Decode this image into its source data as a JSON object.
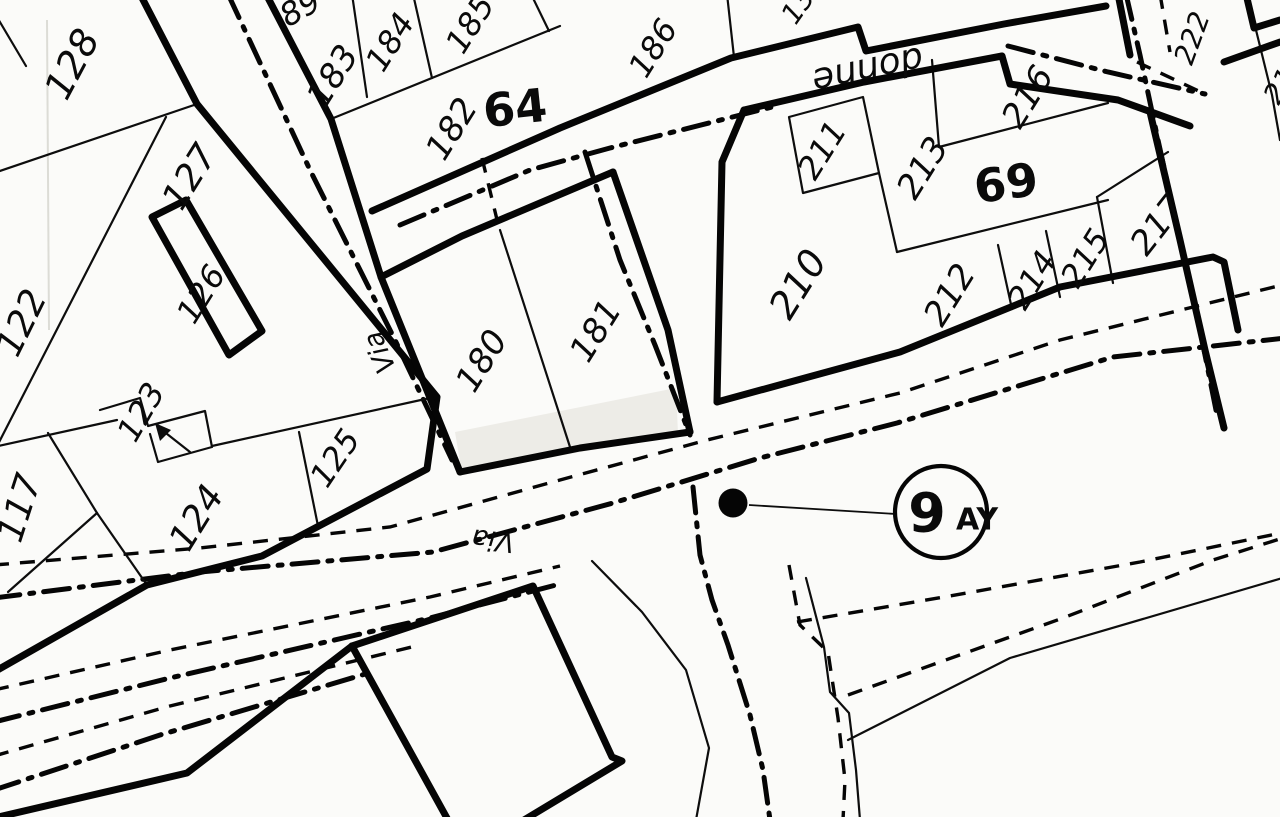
{
  "map": {
    "kind": "cadastral parcel map (scanned, black ink on white paper)",
    "colors": {
      "ink": "#0a0a0a",
      "paper": "#fbfbf9",
      "shade": "#edece7"
    },
    "marker": {
      "circle_label": "9 AY",
      "description": "circled point marker linked by leader line to junction dot"
    }
  },
  "labels": [
    {
      "name": "parcel-128",
      "text": "128",
      "x": 72,
      "y": 64,
      "rot": -62,
      "size": 38,
      "w": "normal",
      "cls": "hand"
    },
    {
      "name": "parcel-127",
      "text": "127",
      "x": 190,
      "y": 177,
      "rot": -58,
      "size": 36,
      "w": "normal",
      "cls": "hand"
    },
    {
      "name": "parcel-126",
      "text": "126",
      "x": 201,
      "y": 294,
      "rot": -58,
      "size": 32,
      "w": "normal",
      "cls": "hand"
    },
    {
      "name": "parcel-122",
      "text": "122",
      "x": 22,
      "y": 323,
      "rot": -64,
      "size": 36,
      "w": "normal",
      "cls": "hand"
    },
    {
      "name": "parcel-123",
      "text": "123",
      "x": 141,
      "y": 412,
      "rot": -60,
      "size": 32,
      "w": "normal",
      "cls": "hand"
    },
    {
      "name": "parcel-117",
      "text": "117",
      "x": 20,
      "y": 508,
      "rot": -72,
      "size": 36,
      "w": "normal",
      "cls": "hand"
    },
    {
      "name": "parcel-124",
      "text": "124",
      "x": 197,
      "y": 518,
      "rot": -58,
      "size": 36,
      "w": "normal",
      "cls": "hand"
    },
    {
      "name": "parcel-125",
      "text": "125",
      "x": 335,
      "y": 458,
      "rot": -56,
      "size": 32,
      "w": "normal",
      "cls": "hand"
    },
    {
      "name": "parcel-183",
      "text": "183",
      "x": 333,
      "y": 76,
      "rot": -58,
      "size": 34,
      "w": "normal",
      "cls": "hand"
    },
    {
      "name": "parcel-184",
      "text": "184",
      "x": 390,
      "y": 42,
      "rot": -58,
      "size": 32,
      "w": "normal",
      "cls": "hand"
    },
    {
      "name": "parcel-185",
      "text": "185",
      "x": 470,
      "y": 24,
      "rot": -58,
      "size": 32,
      "w": "normal",
      "cls": "hand"
    },
    {
      "name": "parcel-182",
      "text": "182",
      "x": 452,
      "y": 129,
      "rot": -58,
      "size": 34,
      "w": "normal",
      "cls": "hand"
    },
    {
      "name": "block-64",
      "text": "64",
      "x": 515,
      "y": 108,
      "rot": -6,
      "size": 46,
      "w": "bold",
      "cls": "blocknum"
    },
    {
      "name": "parcel-186",
      "text": "186",
      "x": 653,
      "y": 48,
      "rot": -58,
      "size": 32,
      "w": "normal",
      "cls": "hand"
    },
    {
      "name": "parcel-180",
      "text": "180",
      "x": 482,
      "y": 361,
      "rot": -58,
      "size": 34,
      "w": "normal",
      "cls": "hand"
    },
    {
      "name": "parcel-181",
      "text": "181",
      "x": 596,
      "y": 331,
      "rot": -58,
      "size": 34,
      "w": "normal",
      "cls": "hand"
    },
    {
      "name": "parcel-211",
      "text": "211",
      "x": 822,
      "y": 150,
      "rot": -58,
      "size": 32,
      "w": "normal",
      "cls": "hand"
    },
    {
      "name": "parcel-213",
      "text": "213",
      "x": 923,
      "y": 168,
      "rot": -58,
      "size": 34,
      "w": "normal",
      "cls": "hand"
    },
    {
      "name": "block-69",
      "text": "69",
      "x": 1006,
      "y": 183,
      "rot": -8,
      "size": 46,
      "w": "bold",
      "cls": "blocknum"
    },
    {
      "name": "parcel-216",
      "text": "216",
      "x": 1028,
      "y": 97,
      "rot": -58,
      "size": 34,
      "w": "normal",
      "cls": "hand"
    },
    {
      "name": "parcel-210",
      "text": "210",
      "x": 798,
      "y": 284,
      "rot": -58,
      "size": 38,
      "w": "normal",
      "cls": "hand"
    },
    {
      "name": "parcel-212",
      "text": "212",
      "x": 950,
      "y": 295,
      "rot": -58,
      "size": 34,
      "w": "normal",
      "cls": "hand"
    },
    {
      "name": "parcel-214",
      "text": "214",
      "x": 1032,
      "y": 280,
      "rot": -58,
      "size": 32,
      "w": "normal",
      "cls": "hand"
    },
    {
      "name": "parcel-215",
      "text": "215",
      "x": 1085,
      "y": 258,
      "rot": -58,
      "size": 32,
      "w": "normal",
      "cls": "hand"
    },
    {
      "name": "parcel-217",
      "text": "217",
      "x": 1158,
      "y": 225,
      "rot": -52,
      "size": 34,
      "w": "normal",
      "cls": "hand"
    },
    {
      "name": "parcel-222",
      "text": "222",
      "x": 1192,
      "y": 38,
      "rot": -70,
      "size": 28,
      "w": "normal",
      "cls": "hand"
    },
    {
      "name": "street-via-northwest",
      "text": "Via",
      "x": 380,
      "y": 352,
      "rot": -113,
      "size": 27,
      "w": "normal",
      "cls": "hand"
    },
    {
      "name": "street-via-southwest",
      "text": "Via",
      "x": 493,
      "y": 540,
      "rot": 186,
      "size": 27,
      "w": "normal",
      "cls": "hand"
    },
    {
      "name": "street-name-fragment",
      "text": "donne",
      "x": 868,
      "y": 70,
      "rot": 168,
      "size": 36,
      "w": "normal",
      "cls": "hand"
    },
    {
      "name": "marker-number",
      "text": "9",
      "x": 927,
      "y": 513,
      "rot": 0,
      "size": 54,
      "w": "bold",
      "cls": "blocknum"
    },
    {
      "name": "marker-suffix",
      "text": "AY",
      "x": 977,
      "y": 520,
      "rot": 0,
      "size": 30,
      "w": "bold",
      "cls": "blocknum"
    },
    {
      "name": "partial-parcel-89",
      "text": "89",
      "x": 300,
      "y": 8,
      "rot": -30,
      "size": 32,
      "w": "normal",
      "cls": "hand"
    },
    {
      "name": "partial-parcel-13",
      "text": "13",
      "x": 798,
      "y": 6,
      "rot": -55,
      "size": 28,
      "w": "normal",
      "cls": "hand"
    },
    {
      "name": "partial-parcel-21",
      "text": "21",
      "x": 1280,
      "y": 86,
      "rot": -58,
      "size": 28,
      "w": "normal",
      "cls": "hand"
    }
  ]
}
